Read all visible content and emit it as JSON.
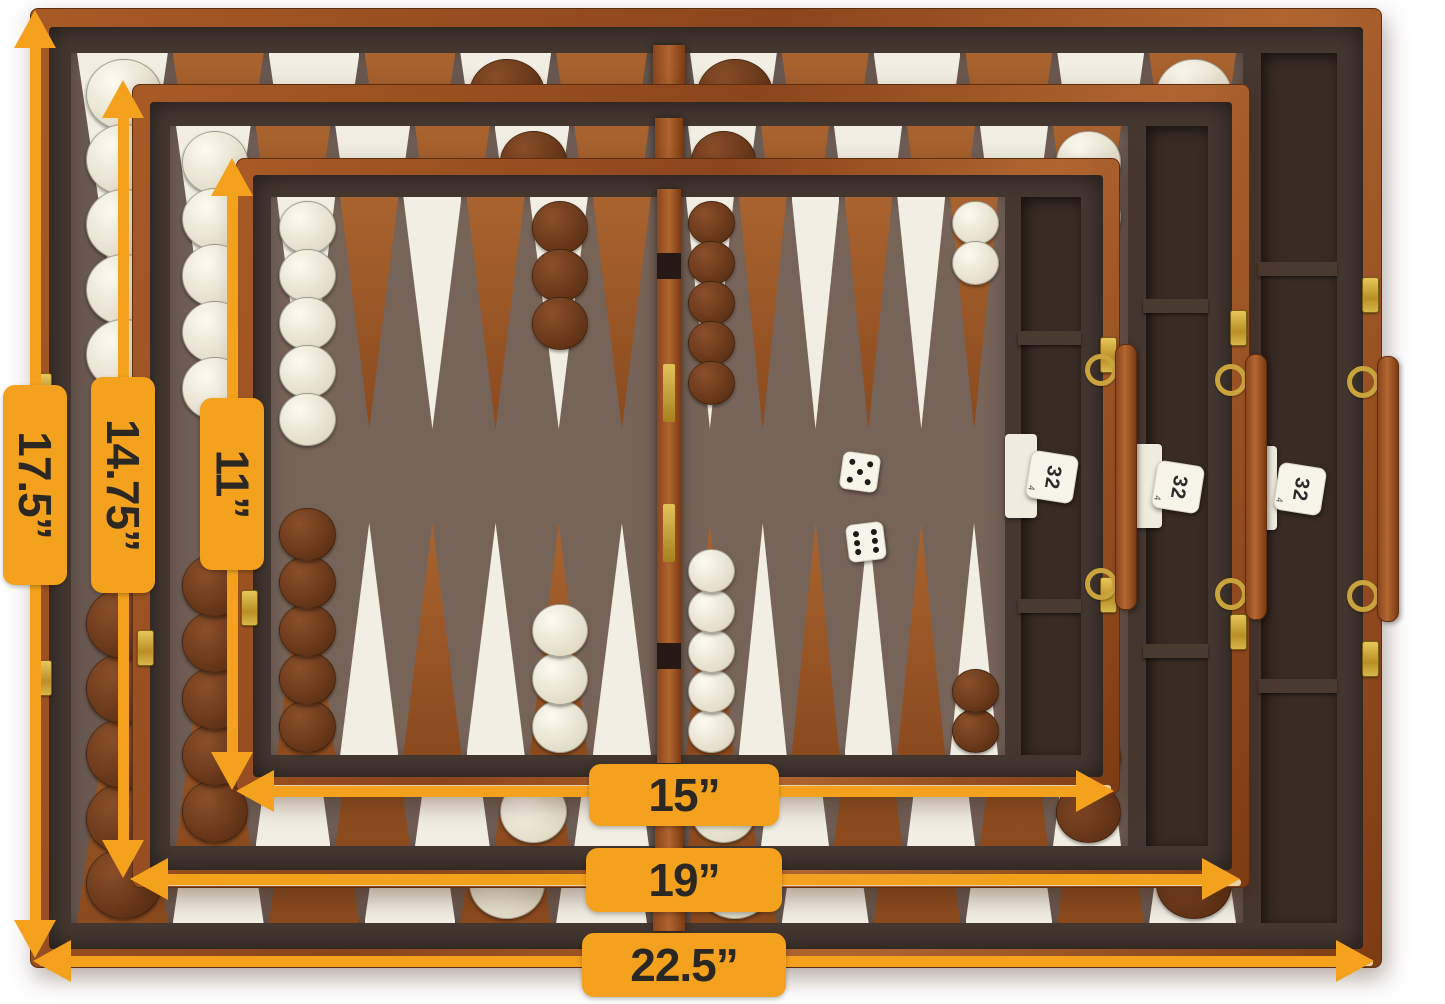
{
  "scene": {
    "alt_text": "Three nested brown leatherette backgammon travel cases shown open from above, each with a felt playing field, white and rust suede points, white and brown checkers, dice, a 32 doubling cube, gold latches and a leather carry handle, annotated with orange dimension arrows.",
    "background_color": "#ffffff"
  },
  "colors": {
    "accent_orange": "#F4A11D",
    "label_text": "#2b2823",
    "case_leather_light": "#b06530",
    "case_leather_dark": "#7d3b14",
    "dark_fabric": "#453831",
    "compartment": "#392c24",
    "felt_large": "#6a5950",
    "felt_medium": "#6f5e55",
    "felt_small": "#776459",
    "point_white": "#f2eee3",
    "point_rust_light": "#a9632f",
    "point_rust_dark": "#8a4a1e",
    "checker_white_light": "#fdfaf0",
    "checker_white_dark": "#d8d1b8",
    "checker_brown_light": "#8a4f2a",
    "checker_brown_dark": "#52280f",
    "gold_hardware": "#c9a43d",
    "dice_white": "#f7f4ea",
    "wood_edge": "#e9d0a8",
    "white_tab": "#f1ece0"
  },
  "dimensions": {
    "vertical": [
      {
        "set": "large",
        "text": "17.5”"
      },
      {
        "set": "medium",
        "text": "14.75”"
      },
      {
        "set": "small",
        "text": "11”"
      }
    ],
    "horizontal": [
      {
        "set": "small",
        "text": "15”"
      },
      {
        "set": "medium",
        "text": "19”"
      },
      {
        "set": "large",
        "text": "22.5”"
      }
    ]
  },
  "sets": [
    {
      "id": "large",
      "closed_length_label": "22.5”",
      "open_height_label": "17.5”",
      "doubling_cube_value": "32"
    },
    {
      "id": "medium",
      "closed_length_label": "19”",
      "open_height_label": "14.75”",
      "doubling_cube_value": "32"
    },
    {
      "id": "small",
      "closed_length_label": "15”",
      "open_height_label": "11”",
      "doubling_cube_value": "32"
    }
  ],
  "hardware": {
    "doubling_cube_value": "32",
    "doubling_cube_side_value": "4",
    "dice_values": [
      5,
      6
    ],
    "dice_on_set": "small",
    "latches_per_case": 4,
    "handles_per_case": 1
  },
  "board_setup": {
    "points_per_half": 6,
    "top_row": [
      {
        "point": 1,
        "color": "white",
        "count": 5
      },
      {
        "point": 5,
        "color": "brown",
        "count": 3
      },
      {
        "point": 7,
        "color": "brown",
        "count": 5
      },
      {
        "point": 12,
        "color": "white",
        "count": 2
      }
    ],
    "bottom_row": [
      {
        "point": 1,
        "color": "brown",
        "count": 5
      },
      {
        "point": 5,
        "color": "white",
        "count": 3
      },
      {
        "point": 7,
        "color": "white",
        "count": 5
      },
      {
        "point": 12,
        "color": "brown",
        "count": 2
      }
    ]
  }
}
